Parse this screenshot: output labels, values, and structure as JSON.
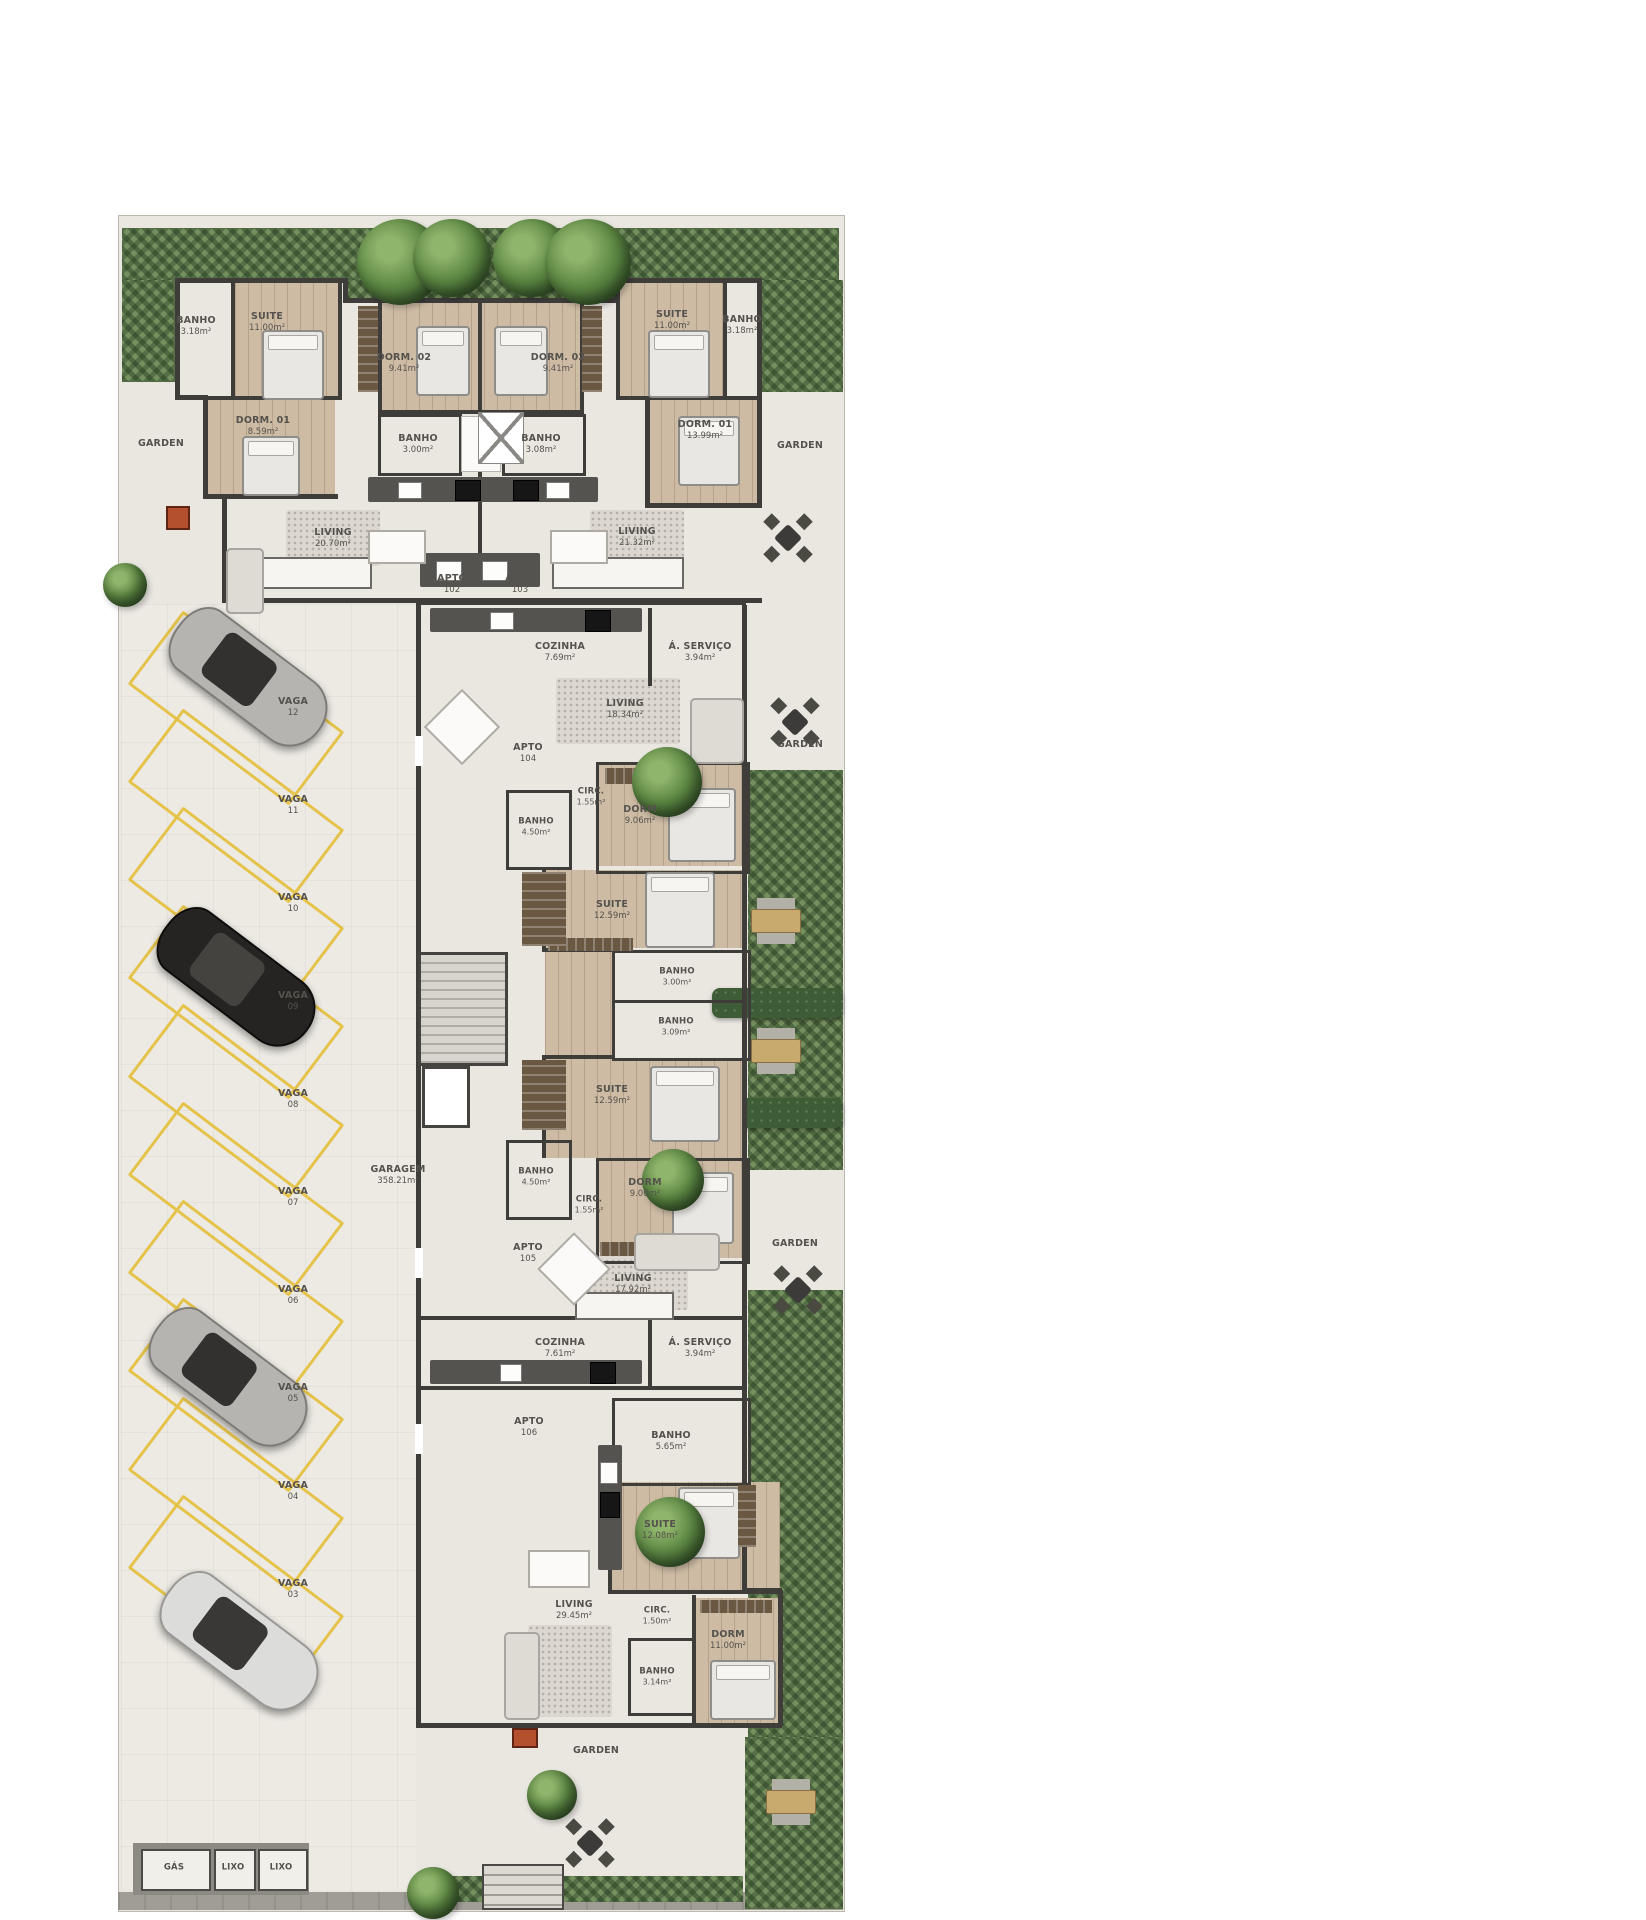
{
  "colors": {
    "wall": "#3f3d3a",
    "plan_background": "#eae7e1",
    "garden_green": "#75905f",
    "parking_yellow": "#e5c34b",
    "wood_floor": "#cdbba4",
    "label_text": "#55524d"
  },
  "apartments": {
    "a102": {
      "label": "APTO",
      "number": "102",
      "banho_suite": {
        "name": "BANHO",
        "area": "3.18m²"
      },
      "suite": {
        "name": "SUITE",
        "area": "11.00m²"
      },
      "dorm2": {
        "name": "DORM. 02",
        "area": "9.41m²"
      },
      "dorm1": {
        "name": "DORM. 01",
        "area": "8.59m²"
      },
      "banho": {
        "name": "BANHO",
        "area": "3.00m²"
      },
      "living": {
        "name": "LIVING",
        "area": "20.70m²"
      }
    },
    "a103": {
      "label": "APTO",
      "number": "103",
      "dorm2": {
        "name": "DORM. 02",
        "area": "9.41m²"
      },
      "suite": {
        "name": "SUITE",
        "area": "11.00m²"
      },
      "banho_suite": {
        "name": "BANHO",
        "area": "3.18m²"
      },
      "dorm1": {
        "name": "DORM. 01",
        "area": "13.99m²"
      },
      "banho": {
        "name": "BANHO",
        "area": "3.08m²"
      },
      "living": {
        "name": "LIVING",
        "area": "21.32m²"
      }
    },
    "a104": {
      "label": "APTO",
      "number": "104",
      "cozinha": {
        "name": "COZINHA",
        "area": "7.69m²"
      },
      "servico": {
        "name": "Á. SERVIÇO",
        "area": "3.94m²"
      },
      "living": {
        "name": "LIVING",
        "area": "18.34m²"
      },
      "circ": {
        "name": "CIRC.",
        "area": "1.55m²"
      },
      "banho": {
        "name": "BANHO",
        "area": "4.50m²"
      },
      "dorm": {
        "name": "DORM",
        "area": "9.06m²"
      },
      "suite": {
        "name": "SUITE",
        "area": "12.59m²"
      },
      "banho2": {
        "name": "BANHO",
        "area": "3.00m²"
      }
    },
    "a105": {
      "label": "APTO",
      "number": "105",
      "banho2": {
        "name": "BANHO",
        "area": "3.09m²"
      },
      "suite": {
        "name": "SUITE",
        "area": "12.59m²"
      },
      "banho": {
        "name": "BANHO",
        "area": "4.50m²"
      },
      "circ": {
        "name": "CIRC.",
        "area": "1.55m²"
      },
      "dorm": {
        "name": "DORM",
        "area": "9.00m²"
      },
      "living": {
        "name": "LIVING",
        "area": "17.92m²"
      },
      "cozinha": {
        "name": "COZINHA",
        "area": "7.61m²"
      },
      "servico": {
        "name": "Á. SERVIÇO",
        "area": "3.94m²"
      }
    },
    "a106": {
      "label": "APTO",
      "number": "106",
      "banho": {
        "name": "BANHO",
        "area": "5.65m²"
      },
      "suite": {
        "name": "SUITE",
        "area": "12.08m²"
      },
      "living": {
        "name": "LIVING",
        "area": "29.45m²"
      },
      "circ": {
        "name": "CIRC.",
        "area": "1.50m²"
      },
      "dorm": {
        "name": "DORM",
        "area": "11.00m²"
      },
      "banho2": {
        "name": "BANHO",
        "area": "3.14m²"
      }
    }
  },
  "garage": {
    "name": "GARAGEM",
    "area": "358.21m²"
  },
  "gardens": {
    "left": "GARDEN",
    "right": "GARDEN",
    "mid": "GARDEN",
    "lower": "GARDEN",
    "bottom": "GARDEN"
  },
  "vagas": [
    {
      "name": "VAGA",
      "num": "12"
    },
    {
      "name": "VAGA",
      "num": "11"
    },
    {
      "name": "VAGA",
      "num": "10"
    },
    {
      "name": "VAGA",
      "num": "09"
    },
    {
      "name": "VAGA",
      "num": "08"
    },
    {
      "name": "VAGA",
      "num": "07"
    },
    {
      "name": "VAGA",
      "num": "06"
    },
    {
      "name": "VAGA",
      "num": "05"
    },
    {
      "name": "VAGA",
      "num": "04"
    },
    {
      "name": "VAGA",
      "num": "03"
    }
  ],
  "utility": {
    "gas": "GÁS",
    "lixo1": "LIXO",
    "lixo2": "LIXO"
  }
}
